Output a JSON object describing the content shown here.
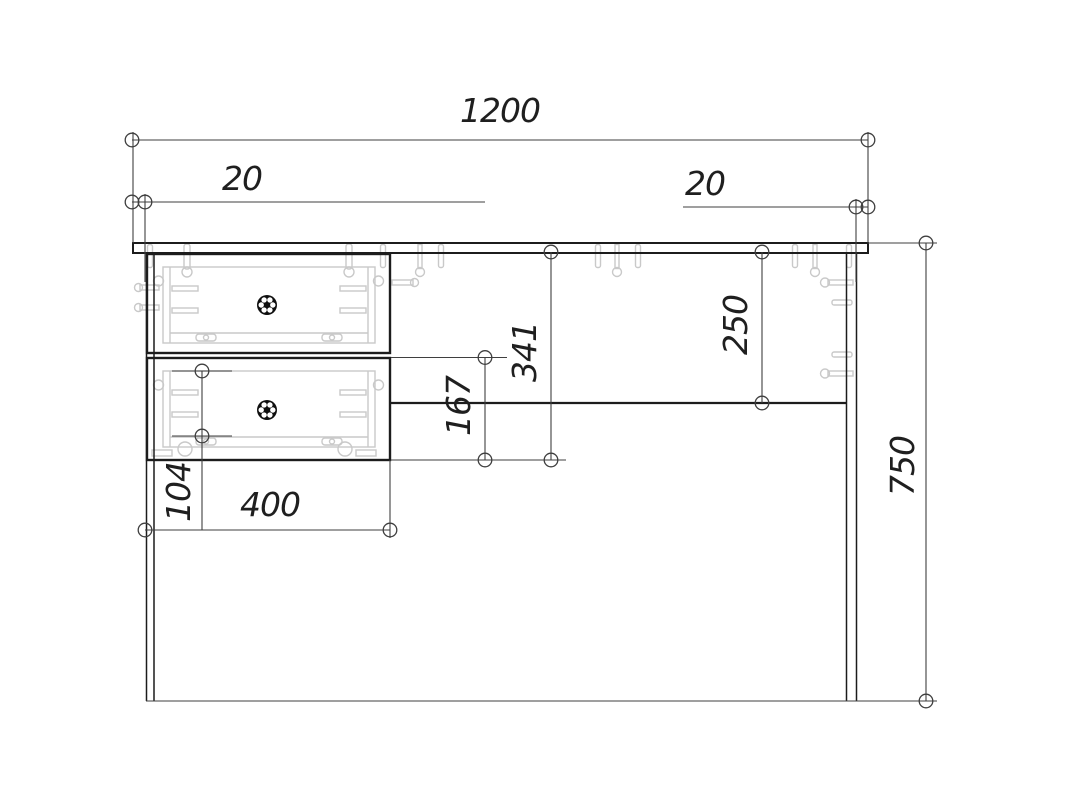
{
  "drawing": {
    "dimensions": {
      "overall_width": "1200",
      "overhang_left": "20",
      "overhang_right": "20",
      "overall_height": "750",
      "drawer_block_height": "341",
      "lower_drawer_height": "167",
      "back_rail_depth": "250",
      "base_offset": "104",
      "drawer_block_width": "400"
    },
    "colors": {
      "background": "#ffffff",
      "outline": "#1c1c1c",
      "dimension_line": "#3f3f3f",
      "hidden_detail": "#c9c9c9",
      "knob": "#0f0f0f",
      "text": "#1f1f1f"
    },
    "icons": {
      "knob": "drawer-knob-icon"
    }
  }
}
